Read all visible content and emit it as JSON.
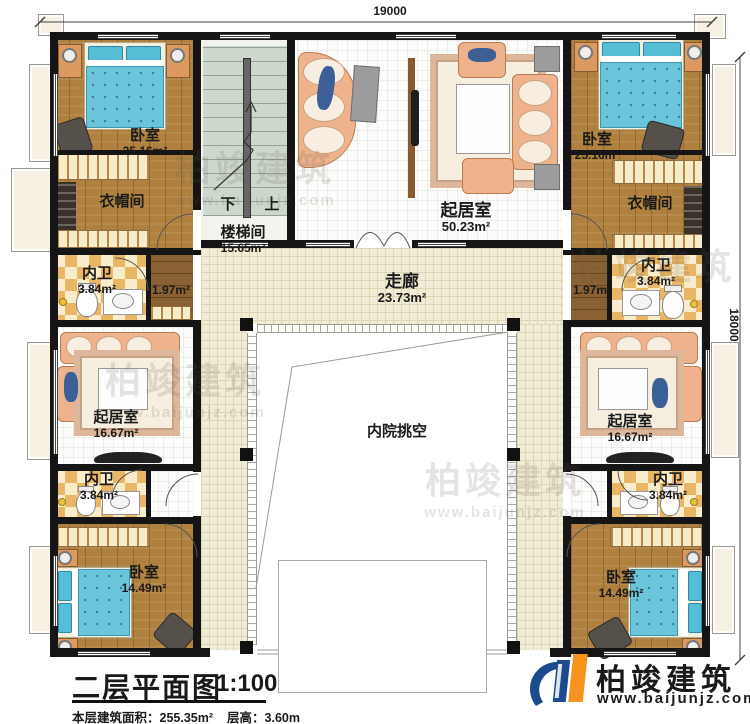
{
  "dimensions": {
    "top": "19000",
    "right": "18000"
  },
  "rooms": {
    "bedroom_tl": {
      "label": "卧室",
      "area": "25.16m²"
    },
    "cloak_tl": {
      "label": "衣帽间"
    },
    "bath_tl": {
      "label": "内卫",
      "area": "3.84m²"
    },
    "corr_tl": {
      "area": "1.97m²"
    },
    "stairwell": {
      "label": "楼梯间",
      "area": "15.65m²",
      "down": "下",
      "up": "上"
    },
    "living_top": {
      "label": "起居室",
      "area": "50.23m²"
    },
    "bedroom_tr": {
      "label": "卧室",
      "area": "25.16m²"
    },
    "cloak_tr": {
      "label": "衣帽间"
    },
    "bath_tr": {
      "label": "内卫",
      "area": "3.84m²"
    },
    "corr_tr": {
      "area": "1.97m²"
    },
    "hallway": {
      "label": "走廊",
      "area": "23.73m²"
    },
    "courtyard": {
      "label": "内院挑空"
    },
    "living_left": {
      "label": "起居室",
      "area": "16.67m²"
    },
    "living_right": {
      "label": "起居室",
      "area": "16.67m²"
    },
    "bath_bl": {
      "label": "内卫",
      "area": "3.84m²"
    },
    "bath_br": {
      "label": "内卫",
      "area": "3.84m²"
    },
    "bedroom_bl": {
      "label": "卧室",
      "area": "14.49m²"
    },
    "bedroom_br": {
      "label": "卧室",
      "area": "14.49m²"
    }
  },
  "title": {
    "main": "二层平面图",
    "scale": "1:100",
    "floor_area": "本层建筑面积：255.35m²",
    "floor_height": "层高：3.60m"
  },
  "logo": {
    "name": "柏竣建筑",
    "url": "www.baijunjz.com"
  },
  "watermark": {
    "name": "柏竣建筑",
    "url": "www.baijunjz.com"
  },
  "colors": {
    "wall": "#151515",
    "wood_floor": "#b0813e",
    "corridor_tile": "#f0ecd5",
    "bed_blue": "#6ac4da",
    "sofa_peach": "#eeb28d",
    "bath_checker": "#e9b665",
    "stair_green": "#cdd8cc",
    "logo_blue": "#1b4a8f",
    "logo_orange": "#f7941d"
  }
}
